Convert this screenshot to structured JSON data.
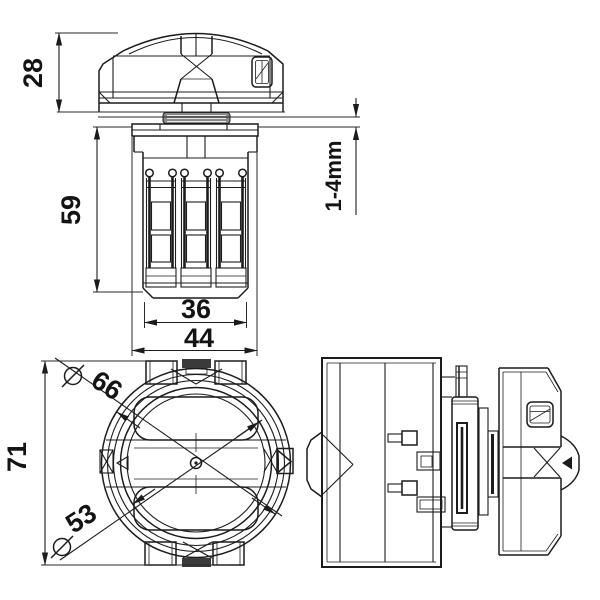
{
  "drawing": {
    "dimensions": {
      "knob_height": "28",
      "body_height": "59",
      "terminal_width": "36",
      "body_width": "44",
      "panel_thickness": "1-4mm",
      "front_diameter": "66",
      "inner_diameter": "53",
      "overall_size": "71"
    },
    "symbols": {
      "diameter": "circle-slash"
    },
    "colors": {
      "line": "#1c1c1c",
      "background": "#ffffff"
    }
  }
}
